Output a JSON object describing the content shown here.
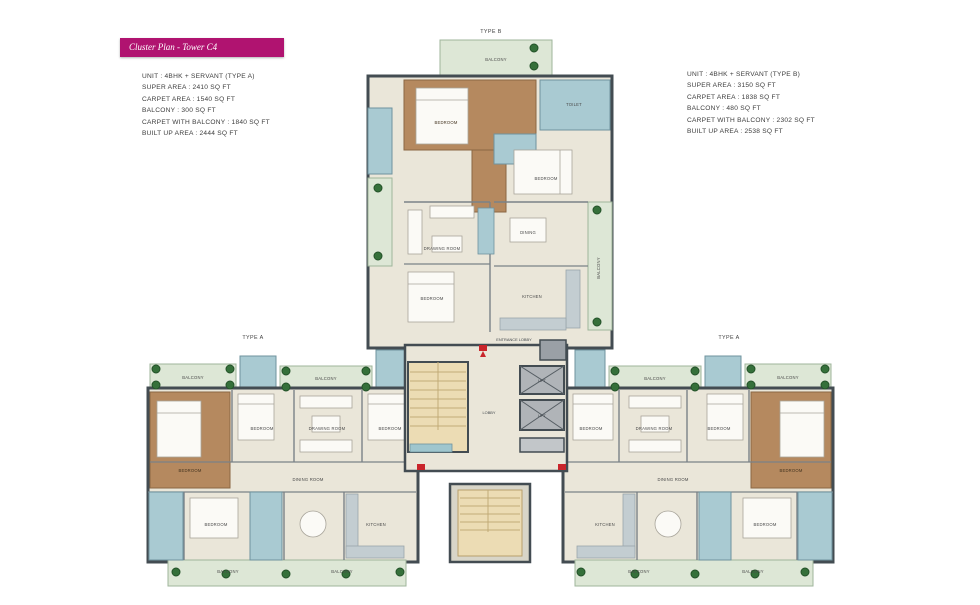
{
  "badge": {
    "label": "Cluster Plan - Tower C4"
  },
  "specs": {
    "left": {
      "lines": [
        "UNIT : 4BHK + SERVANT (TYPE A)",
        "SUPER AREA : 2410 SQ FT",
        "CARPET AREA : 1540 SQ FT",
        "BALCONY : 300 SQ FT",
        "CARPET WITH BALCONY : 1840 SQ FT",
        "BUILT UP AREA : 2444 SQ FT"
      ]
    },
    "right": {
      "lines": [
        "UNIT : 4BHK + SERVANT (TYPE B)",
        "SUPER AREA : 3150 SQ FT",
        "CARPET AREA : 1838 SQ FT",
        "BALCONY : 480 SQ FT",
        "CARPET WITH BALCONY : 2302 SQ FT",
        "BUILT UP AREA : 2538 SQ FT"
      ]
    }
  },
  "plan": {
    "labels": {
      "type_a": "TYPE A",
      "type_b": "TYPE B",
      "balcony": "BALCONY",
      "bedroom": "BEDROOM",
      "drawing_room": "DRAWING ROOM",
      "dining_room": "DINING ROOM",
      "dining": "DINING",
      "kitchen": "KITCHEN",
      "toilet": "TOILET",
      "lobby": "LOBBY",
      "entrance_lobby": "ENTRANCE LOBBY",
      "lift": "LIFT"
    },
    "colors": {
      "badge_bg": "#b01370",
      "wall": "#434c52",
      "floor": "#eae6d9",
      "balcony_green": "#dde7d6",
      "master_brown": "#b5895f",
      "bath_blue": "#a9cad2",
      "stair_tan": "#ecdcb4",
      "lift_gray": "#b0b4b8",
      "plant_green": "#35703a",
      "entry_red": "#c9252b"
    }
  }
}
